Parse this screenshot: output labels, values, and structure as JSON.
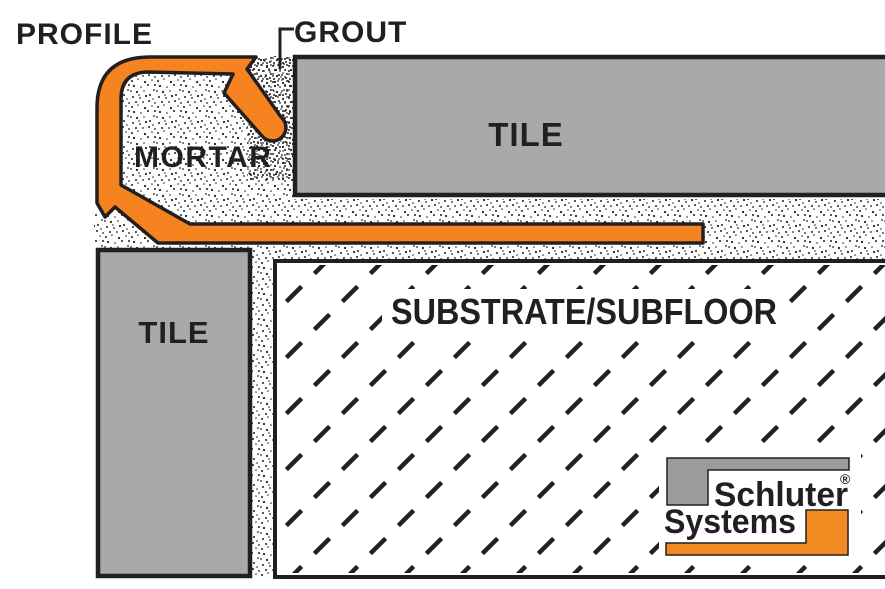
{
  "labels": {
    "profile": "PROFILE",
    "grout": "GROUT",
    "mortar": "MORTAR",
    "tile_top": "TILE",
    "tile_left": "TILE",
    "substrate": "SUBSTRATE/SUBFLOOR"
  },
  "logo": {
    "word1": "Schluter",
    "word2": "Systems",
    "registered_mark": "®"
  },
  "colors": {
    "profile_orange": "#F5831F",
    "logo_orange": "#F18A21",
    "tile_gray": "#A8A9AB",
    "logo_gray": "#9B9B9D",
    "line_black": "#231F20"
  }
}
